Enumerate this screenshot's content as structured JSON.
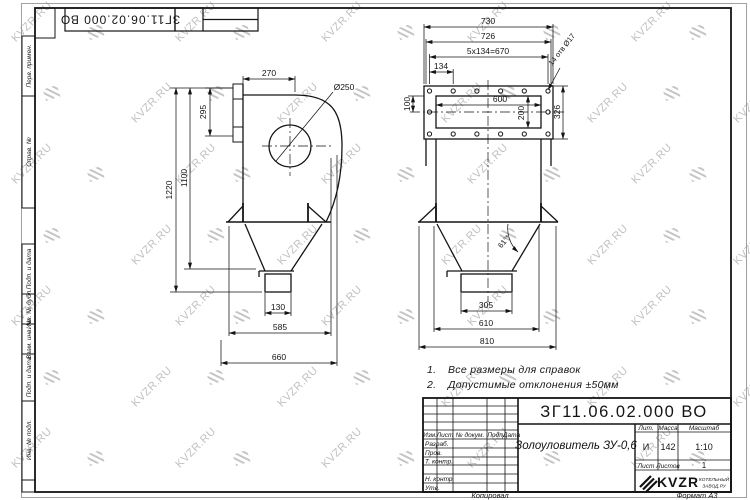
{
  "watermark": {
    "text": "KVZR.RU"
  },
  "margin": {
    "labels": {
      "perv": "Перв. примен.",
      "sprav": "Справ. №",
      "podp_data_1": "Подп. и дата",
      "inv_dubl": "Инв. № дубл.",
      "vzam_inv": "Взам. инв. №",
      "podp_data_2": "Подп. и дата",
      "inv_podl": "Инв. № подл."
    }
  },
  "views": {
    "left": {
      "dims": {
        "d270": "270",
        "d295": "295",
        "d1220": "1220",
        "d1100": "1100",
        "dia250": "Ø250",
        "d130": "130",
        "d585": "585",
        "d660": "660"
      }
    },
    "right": {
      "dims": {
        "d730": "730",
        "d726": "726",
        "d670": "5x134=670",
        "d134": "134",
        "d100": "100",
        "d600": "600",
        "d200": "200",
        "d326": "326",
        "holes": "14 отв Ø17",
        "angle": "61°*",
        "d305": "305",
        "d610": "610",
        "d810": "810"
      }
    }
  },
  "notes": {
    "items": [
      {
        "num": "1.",
        "text": "Все размеры для справок"
      },
      {
        "num": "2.",
        "text": "Допустимые отклонения ±50мм"
      }
    ]
  },
  "title_block": {
    "doc_number": "ЗГ11.06.02.000 ВО",
    "product_name": "Золоуловитель ЗУ-0,6",
    "headers": {
      "lit": "Лит.",
      "massa": "Масса",
      "masshtab": "Масштаб",
      "list": "Лист",
      "listov": "Листов"
    },
    "values": {
      "lit": "И",
      "massa": "142",
      "masshtab": "1:10",
      "listov_count": "1"
    },
    "sign_rows": {
      "izm": "Изм.",
      "list": "Лист",
      "n_dokum": "№ докум.",
      "podp": "Подп.",
      "data": "Дата",
      "razrab": "Разраб.",
      "prov": "Пров.",
      "t_kontr": "Т. контр.",
      "n_kontr": "Н. контр.",
      "utv": "Утв."
    },
    "company": {
      "logo": "KVZR",
      "line1": "КОТЕЛЬНЫЙ",
      "line2": "ЗАВОД.РУ"
    }
  },
  "footer": {
    "copied": "Копировал",
    "format": "Формат А3"
  }
}
